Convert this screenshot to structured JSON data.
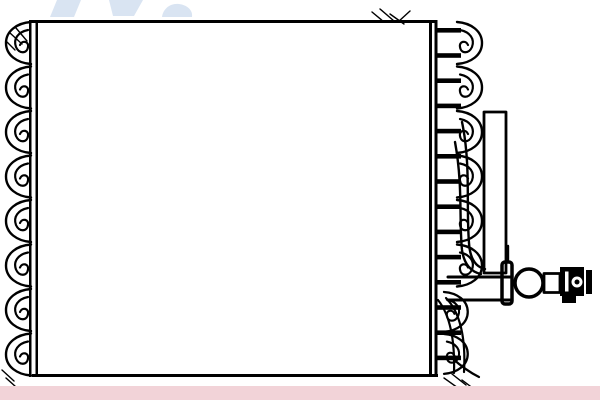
{
  "meta": {
    "description": "Black-and-white technical line drawing of an automotive air-conditioning evaporator core with corrugated side fins, tube ladder, tall outlet pipe and end fitting",
    "background": "#ffffff"
  },
  "colors": {
    "line": "#000000",
    "core_fill": "#ffffff",
    "watermark_blue": "#d9e4f2",
    "hatch_gray": "#d6dbe1",
    "band_pink": "#f2d3d8"
  },
  "watermark": {
    "name": "partial-logo-watermark",
    "shape_count": 3
  },
  "core": {
    "name": "evaporator-core-body",
    "left_fin_scallops": 8,
    "right_fin_scallops": 6,
    "lower_right_fin_scallops": 2,
    "tube_rungs": 14
  },
  "pipe": {
    "name": "outlet-pipe"
  },
  "fitting": {
    "name": "pipe-end-fitting",
    "elements": [
      "clamp-bracket",
      "flange-circle",
      "cylinder-segment",
      "connector-block",
      "end-cap"
    ]
  },
  "band": {
    "name": "bottom-highlight-band"
  }
}
